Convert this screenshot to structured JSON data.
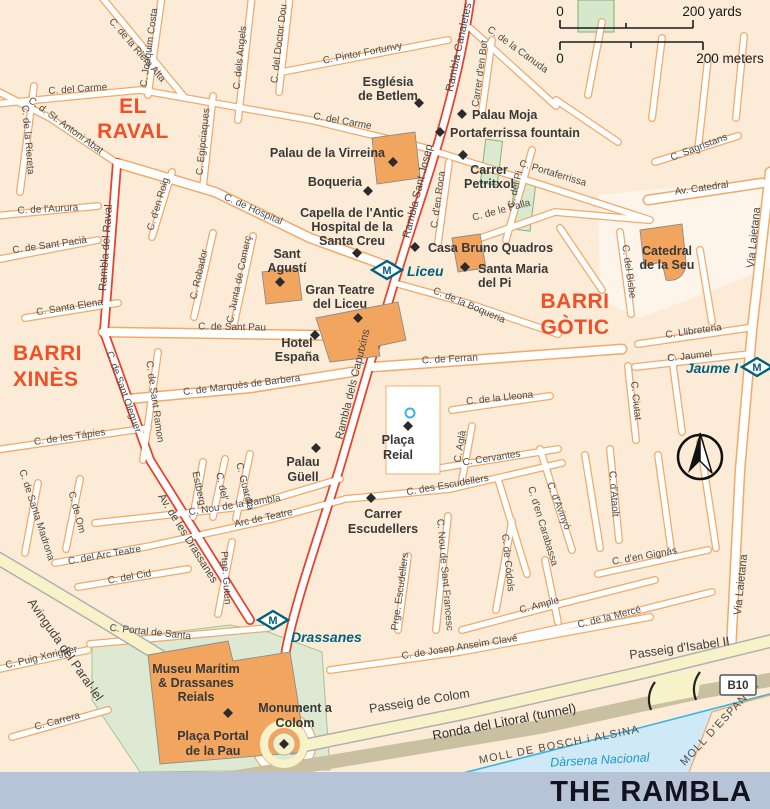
{
  "title": "THE RAMBLA",
  "scale_bar": {
    "zero_yards": "0",
    "yards_label": "200 yards",
    "zero_meters": "0",
    "meters_label": "200 meters"
  },
  "districts": {
    "el_raval": [
      "EL",
      "RAVAL"
    ],
    "barri_xines": [
      "BARRI",
      "XINÈS"
    ],
    "barri_gotic": [
      "BARRI",
      "GÒTIC"
    ]
  },
  "metro": {
    "m": "M",
    "liceu": "Liceu",
    "jaume_i": "Jaume I",
    "drassanes": "Drassanes"
  },
  "badges": {
    "b10": "B10"
  },
  "water": {
    "darsena": "Dàrsena Nacional"
  },
  "harbor": {
    "moll_bosch": "MOLL DE BOSCH i ALSINA",
    "moll_espanya": "MOLL D'ESPANYA"
  },
  "pois": {
    "betlem": [
      "Església",
      "de Betlem"
    ],
    "palau_moja": "Palau Moja",
    "portaferrissa_fountain": "Portaferrissa fountain",
    "palau_virreina": "Palau de la Virreina",
    "boqueria": "Boqueria",
    "carrer_petritxol": [
      "Carrer",
      "Petritxol"
    ],
    "capella": [
      "Capella de l'Antic",
      "Hospital de la",
      "Santa Creu"
    ],
    "casa_bruno": "Casa Bruno Quadros",
    "santa_maria": [
      "Santa Maria",
      "del Pi"
    ],
    "sant_agusti": [
      "Sant",
      "Agustí"
    ],
    "gran_teatre": [
      "Gran Teatre",
      "del Liceu"
    ],
    "hotel_espana": [
      "Hotel",
      "España"
    ],
    "catedral": [
      "Catedral",
      "de la Seu"
    ],
    "palau_guell": [
      "Palau",
      "Güell"
    ],
    "placa_reial": [
      "Plaça",
      "Reial"
    ],
    "carrer_escudellers": [
      "Carrer",
      "Escudellers"
    ],
    "museu_maritim": [
      "Museu Marítim",
      "& Drassanes",
      "Reials"
    ],
    "placa_portal": [
      "Plaça Portal",
      "de la Pau"
    ],
    "monument_colom": [
      "Monument a",
      "Colom"
    ]
  },
  "streets": {
    "riera_alta": "C. de la Riera Alta",
    "joaquim_costa": "C. Joaquim Costa",
    "dels_angels": "C. dels Angels",
    "doctor_dou": "C. del Doctor Dou",
    "pintor_fortunvy": "C. Pintor Fortunvy",
    "carme": "C. del Carme",
    "antoni_abat": "C. d. St. Antoni Abat",
    "riereta": "C. de la Riereta",
    "aurura": "C. de  l'Aurura",
    "sant_pacia": "C. de Sant Pacià",
    "rambla_raval": "Rambla del Raval",
    "den_roig": "C. d'en Roig",
    "egipciaques": "C. Egipciaques",
    "hospital": "C. de Hospital",
    "robador": "C. Robador",
    "junta_comerc": "C. Junta de Comerç",
    "sant_pau": "C. de Sant Pau",
    "santa_elena": "C. Santa Elena",
    "marques_barbera": "C. de Marquès de Barbera",
    "tapies": "C. de les Tápies",
    "sant_oleguer": "C. de Sant Oleguer",
    "sant_ramon": "C. de Sant Ramon",
    "nou_rambla": "C. Nou de la Rambla",
    "estberg": "Estberg",
    "c_del": "C. del'",
    "guardia": "C. Guardia",
    "arc_teatre": "Arc de Teatre",
    "arc_teatre_w": "C. del Arc Teatre",
    "cid": "C. del Cid",
    "portal_santa": "C. Portal de Santa",
    "ptge_guten": "Ptge. Guten",
    "santa_madrona": "C. de Santa Madrona",
    "om": "C. de Om",
    "av_drassanes": "Av. de les Drassanes",
    "puig_xoriguer": "C. Puig Xoriguer",
    "carrera": "C. Carrera",
    "parallel": "Avinguda del Paral·lel",
    "passeig_colom": "Passeig de Colom",
    "passeig_isabel": "Passeig d'Isabel II",
    "ronda_litoral": "Ronda del Litoral (tunnel)",
    "josep_clave": "C. de Josep Anseim Clavé",
    "prge_escudellers": "Prge. Escudellers",
    "nou_sant_francesc": "C. Nou de Sant Francesc",
    "codols": "C. de Códols",
    "carabassa": "C. d'en Carabassa",
    "avinyo": "C. d'Avinyó",
    "ataolt": "C. d'Ataolt",
    "ample": "C. Ample",
    "merce": "C. de la Mercé",
    "gignas": "C. d'en Gignás",
    "cervantes": "C. Cervantes",
    "agla": "C. Aglà",
    "lleona": "C. de la Lleona",
    "ferran": "C. de Ferran",
    "des_escudellers": "C. des Escudellers",
    "boqueria_st": "C. de la Boqueria",
    "ciutat": "C. Ciutat",
    "bisbe": "C. del Bisbe",
    "llibreteria": "C. Llibreteria",
    "jaumel": "C. Jaumel",
    "sagristans": "C. Sagristans",
    "av_catedral": "Av. Catedral",
    "palla": "C. de le Palla",
    "pi": "C. del Pi",
    "portaferrissa": "C. Portaferrissa",
    "canuda": "C. de la Canuda",
    "den_bot": "Carrer d'en Bot",
    "den_roca": "C. d'en Roca",
    "rambla_canaletes": "Rambla Canaletes",
    "rambla_sant_josep": "Rambla Sant Josep",
    "rambla_caputxins": "Rambla dels Caputxins",
    "via_laietana": "Via Laietana"
  },
  "colors": {
    "district_label": "#f05028",
    "metro": "#00617e",
    "building": "#f2a55e",
    "road_casing": "#f2a968",
    "rambla_red": "#e8402a",
    "yellow_road": "#f8f2c8",
    "tan_road": "#c9c0a2",
    "water": "#cfe9f6",
    "park": "#dce8d2",
    "title_band": "#b7c3d6",
    "background": "#fcecd7"
  }
}
